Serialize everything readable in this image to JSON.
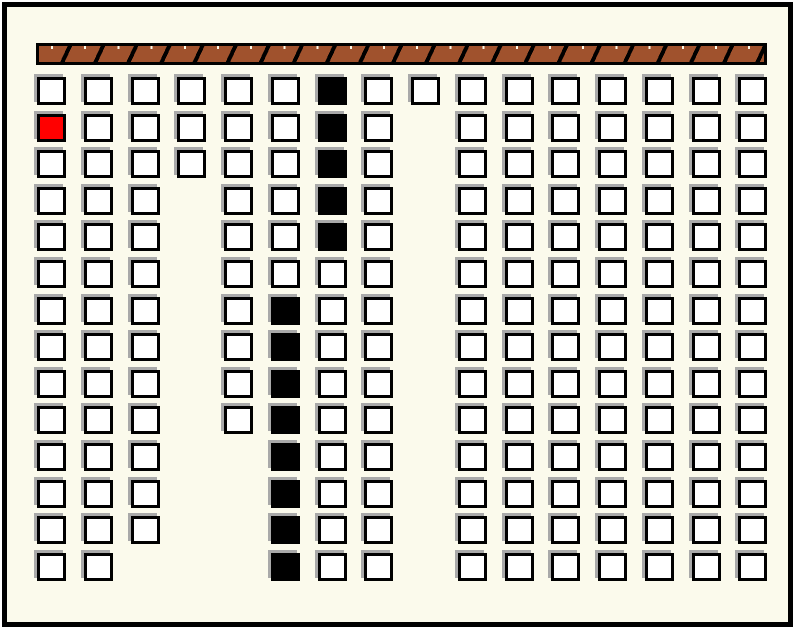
{
  "window": {
    "outer_background": "#ffffff",
    "frame_color": "#000000",
    "frame": {
      "x": 2,
      "y": 2,
      "width": 791,
      "height": 625,
      "border_width": 5
    },
    "background": "#fbfaec"
  },
  "hatch_bar": {
    "x": 36,
    "y": 43,
    "width": 731,
    "height": 22,
    "fill_color": "#a0522d",
    "frame_color": "#000000",
    "tick_color": "#fff8e4",
    "segment_pitch": 33.2,
    "separator_width": 4,
    "segment_count": 22
  },
  "grid": {
    "cols": 16,
    "rows": 14,
    "origin_x": 37,
    "origin_y": 77,
    "pitch_x": 46.75,
    "pitch_y": 36.6,
    "cell_width": 29,
    "cell_height": 28,
    "cell_border_color": "#000000",
    "cell_border_width": 3,
    "shadow_color": "#a9a9a9",
    "shadow_offset_x": -3,
    "shadow_offset_y": -3,
    "cell_colors": {
      "white": "#ffffff",
      "black": "#000000",
      "red": "#ff0000"
    },
    "legend": {
      "W": "white block",
      "B": "black block",
      "R": "red block",
      ".": "empty"
    },
    "rows_map": [
      "WWWWWWBWWWWWWWWW",
      "RWWWWWBW.WWWWWWW",
      "WWWWWWBW.WWWWWWW",
      "WWW.WWBW.WWWWWWW",
      "WWW.WWBW.WWWWWWW",
      "WWW.WWWW.WWWWWWW",
      "WWW.WBWW.WWWWWWW",
      "WWW.WBWW.WWWWWWW",
      "WWW.WBWW.WWWWWWW",
      "WWW.WBWW.WWWWWWW",
      "WWW..BWW.WWWWWWW",
      "WWW..BWW.WWWWWWW",
      "WWW..BWW.WWWWWWW",
      "WW...BWW.WWWWWWW"
    ],
    "counts": {
      "white": 181,
      "black": 13,
      "red": 1,
      "empty": 29
    }
  }
}
